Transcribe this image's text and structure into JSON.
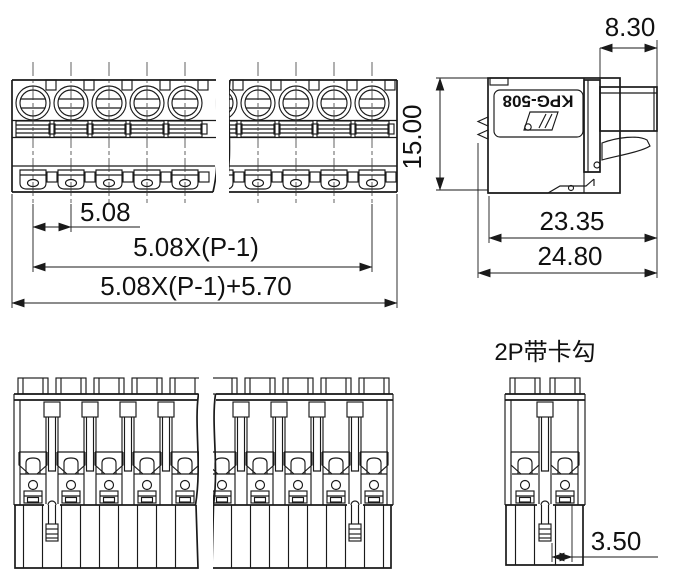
{
  "meta": {
    "background_color": "#ffffff",
    "line_color": "#1a1a1a"
  },
  "front_view": {
    "dim_pitch": "5.08",
    "dim_span": "5.08X(P-1)",
    "dim_total": "5.08X(P-1)+5.70"
  },
  "side_view": {
    "part_label": "KPG-508",
    "dim_plug_width": "8.30",
    "dim_height": "15.00",
    "dim_depth_body": "23.35",
    "dim_depth_total": "24.80"
  },
  "hook_view": {
    "title": "2P带卡勾",
    "dim_hook_offset": "3.50"
  }
}
